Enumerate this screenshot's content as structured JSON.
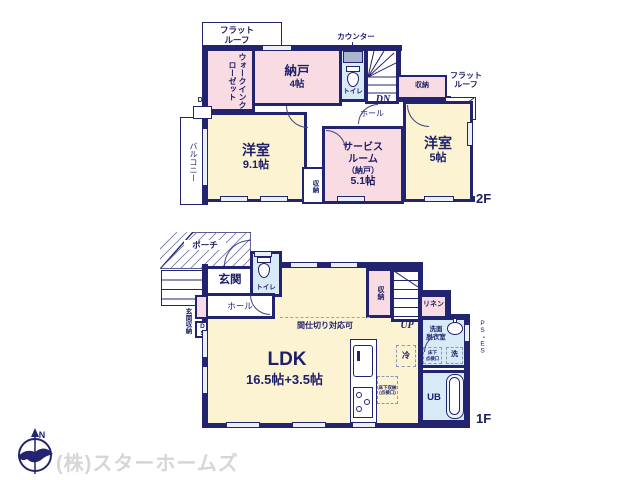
{
  "colors": {
    "wall": "#232470",
    "room_cream": "#fcf3d3",
    "room_pink": "#f9dce3",
    "room_blue": "#d9eaf7",
    "counter_gray": "#a9b6cb",
    "logo_gray": "#d6d6d6"
  },
  "floor2": {
    "label": "2F",
    "flat_roof_left_l1": "フラット",
    "flat_roof_left_l2": "ルーフ",
    "flat_roof_right_l1": "フラット",
    "flat_roof_right_l2": "ルーフ",
    "wic": "ウォークインクローゼット",
    "nando_name": "納戸",
    "nando_size": "4帖",
    "counter": "カウンター",
    "toilet": "トイレ",
    "dn": "DN",
    "hall": "ホール",
    "closet_top": "収納",
    "closet_mid": "収納",
    "ds": "DS",
    "balcony": "バルコニー",
    "west_room_l_name": "洋室",
    "west_room_l_size": "9.1帖",
    "service_l1": "サービス",
    "service_l2": "ルーム",
    "service_l3": "（納戸）",
    "service_l4": "5.1帖",
    "west_room_r_name": "洋室",
    "west_room_r_size": "5帖"
  },
  "floor1": {
    "label": "1F",
    "porch": "ポーチ",
    "entrance": "玄関",
    "toilet": "トイレ",
    "hall": "ホール",
    "entrance_storage": "玄関収納",
    "ds": "DS",
    "closet": "収納",
    "up": "UP",
    "linen": "リネン",
    "partition": "間仕切り対応可",
    "washroom_l1": "洗面",
    "washroom_l2": "脱衣室",
    "ps_es": "PS・ES",
    "hatch_l1": "床下",
    "hatch_l2": "点検口",
    "washer": "洗",
    "fridge": "冷",
    "ldk_name": "LDK",
    "ldk_size": "16.5帖+3.5帖",
    "underfloor_l1": "床下収納",
    "underfloor_l2": "(点検口)",
    "ub": "UB"
  },
  "footer": {
    "company": "(株)スターホームズ",
    "north": "N"
  }
}
